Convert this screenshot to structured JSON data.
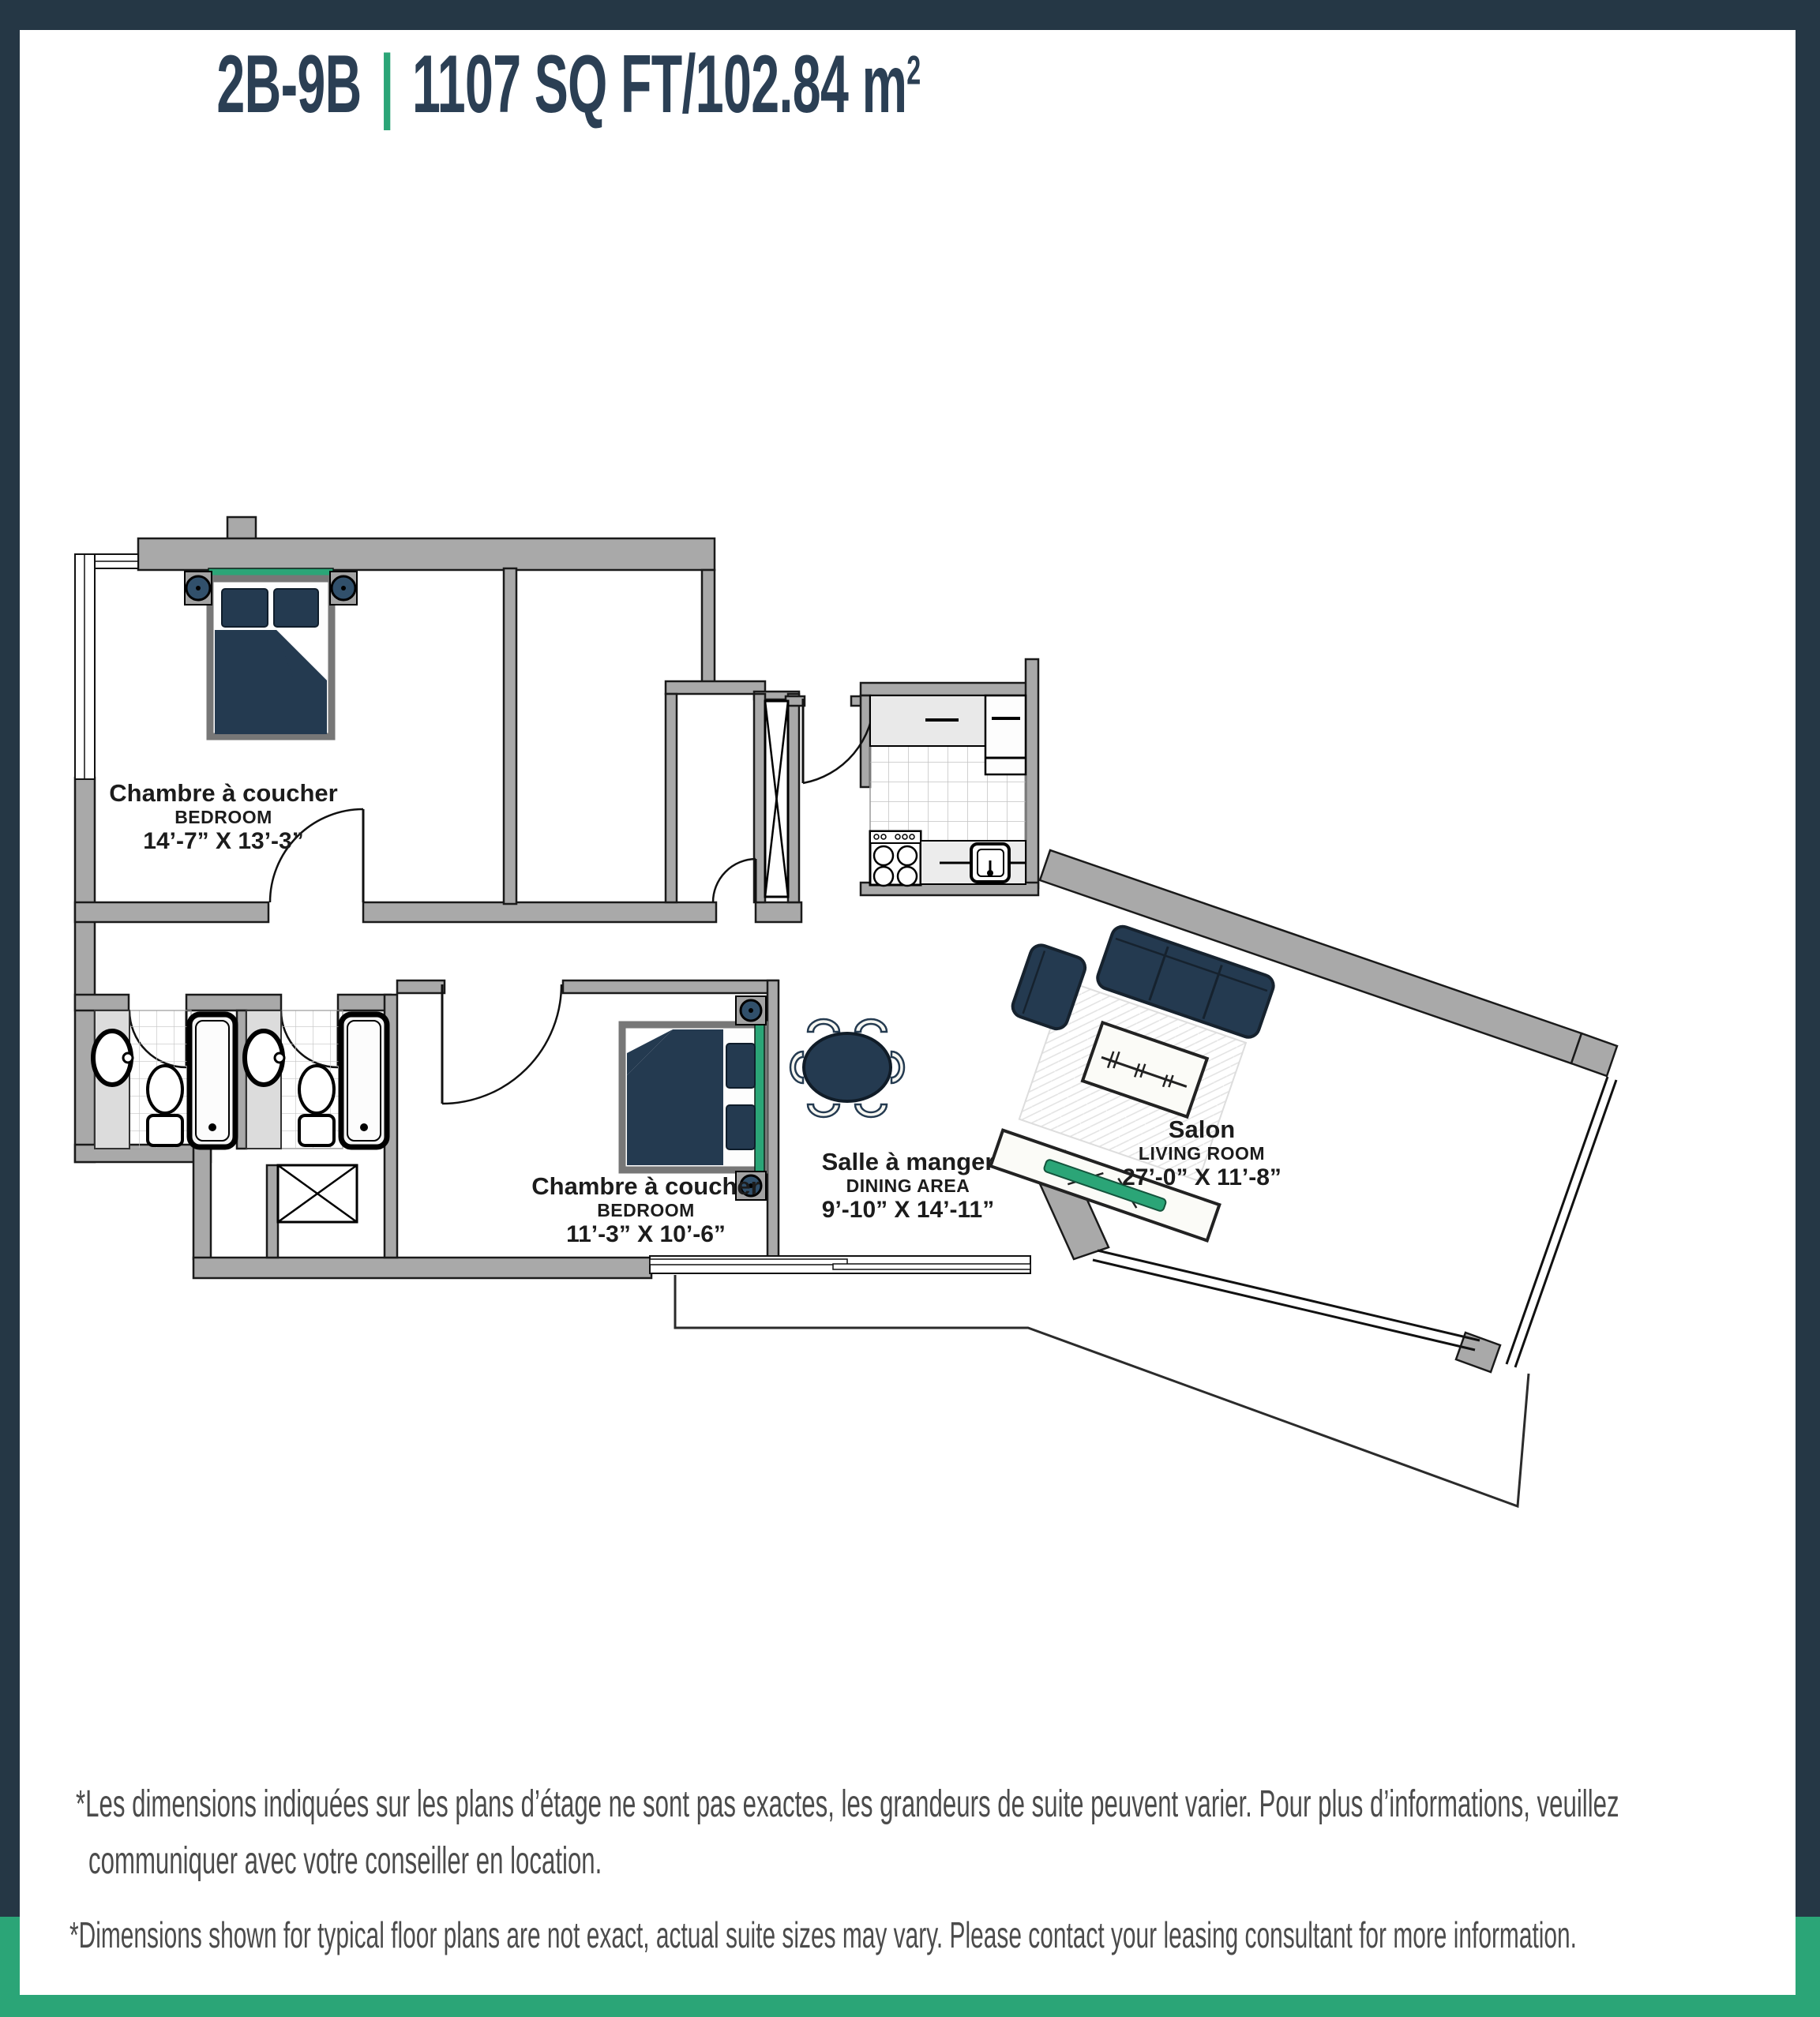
{
  "header": {
    "unit": "2B-9B",
    "separator": "|",
    "area": "1107 SQ FT/102.84 m",
    "area_exponent": "2"
  },
  "colors": {
    "frame_navy": "#253745",
    "accent_green": "#2ba577",
    "title_text": "#2b3f54",
    "furniture_navy": "#243a50",
    "wall_grey": "#a9a9a9",
    "label_text": "#1c1c1c",
    "disclaimer_text": "#4b4b4b"
  },
  "rooms": {
    "bedroom1": {
      "name_fr": "Chambre à coucher",
      "name_en": "BEDROOM",
      "dimensions": "14’-7” X 13’-3”"
    },
    "bedroom2": {
      "name_fr": "Chambre à coucher",
      "name_en": "BEDROOM",
      "dimensions": "11’-3” X 10’-6”"
    },
    "dining": {
      "name_fr": "Salle à manger",
      "name_en": "DINING AREA",
      "dimensions": "9’-10” X 14’-11”"
    },
    "living": {
      "name_fr": "Salon",
      "name_en": "LIVING ROOM",
      "dimensions": "27’-0” X 11’-8”"
    }
  },
  "disclaimers": {
    "fr_line1": "*Les dimensions indiquées sur les plans d’étage ne sont pas exactes, les grandeurs de suite peuvent varier. Pour plus d’informations, veuillez",
    "fr_line2": "communiquer avec votre conseiller en location.",
    "en": "*Dimensions shown for typical floor plans are not exact, actual suite sizes may vary. Please contact your leasing consultant for more information."
  }
}
